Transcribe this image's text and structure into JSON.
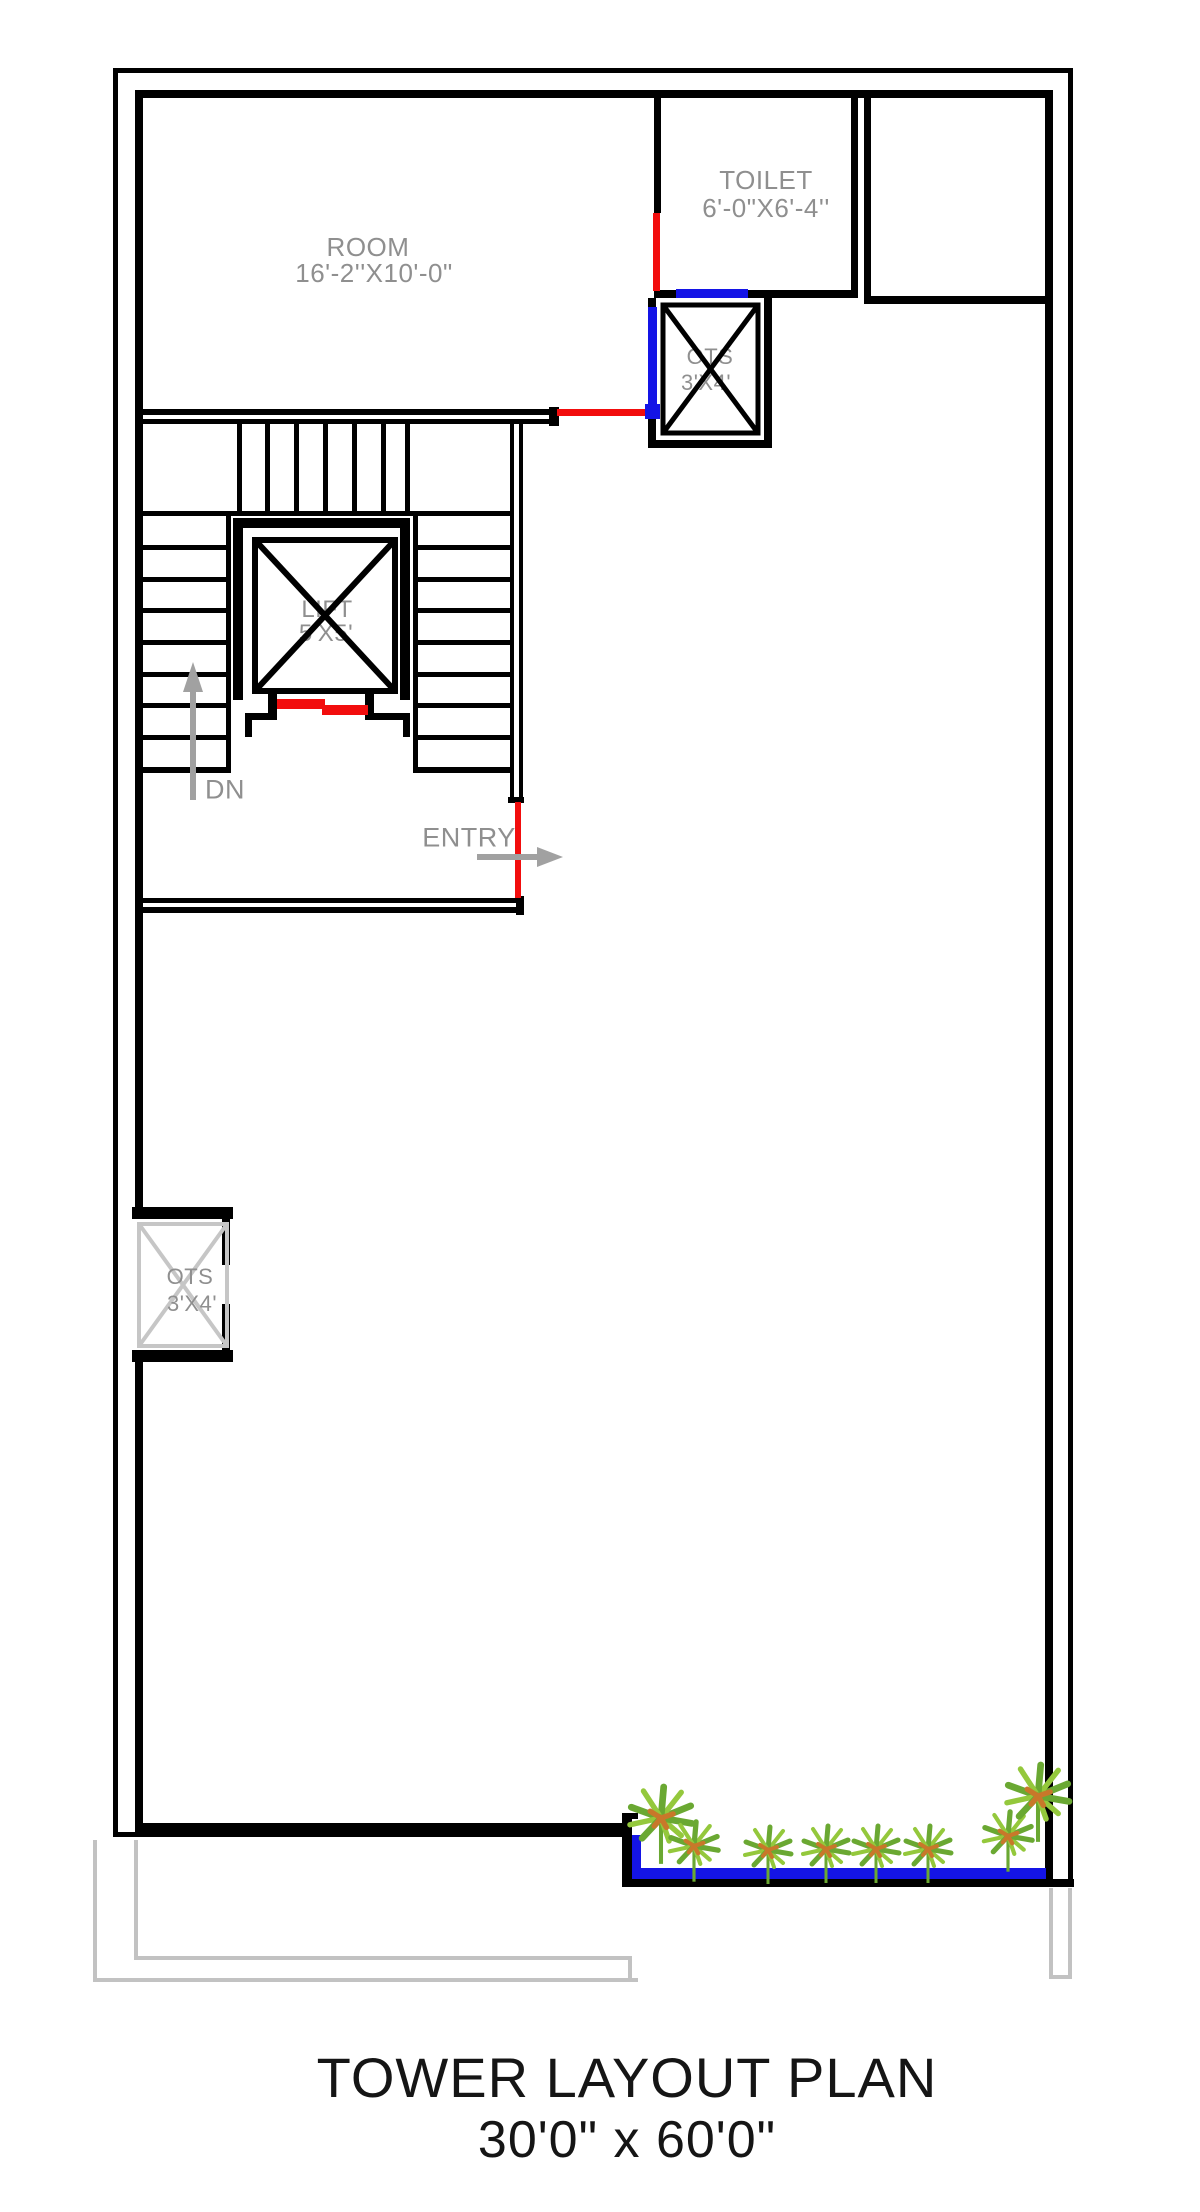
{
  "title": {
    "line1": "TOWER LAYOUT PLAN",
    "line2": "30'0\" x 60'0\""
  },
  "rooms": {
    "room": {
      "name": "ROOM",
      "dim": "16'-2''X10'-0\""
    },
    "toilet": {
      "name": "TOILET",
      "dim": "6'-0\"X6'-4''"
    },
    "ots_top": {
      "name": "OTS",
      "dim": "3'X4'"
    },
    "ots_left": {
      "name": "OTS",
      "dim": "3'X4'"
    },
    "lift": {
      "name": "LIFT",
      "dim": "5'X5'"
    }
  },
  "annotations": {
    "entry": "ENTRY",
    "down": "DN"
  },
  "colors": {
    "wall": "#000000",
    "door": "#f20d0d",
    "window": "#1414e6",
    "label": "#8f8f8f",
    "open-boundary": "#c2c2c2",
    "ots-cross": "#c6c6c6",
    "arrow": "#a1a1a1",
    "plant-green-dark": "#6aa832",
    "plant-green-light": "#94c83c",
    "plant-orange": "#c8782a"
  }
}
